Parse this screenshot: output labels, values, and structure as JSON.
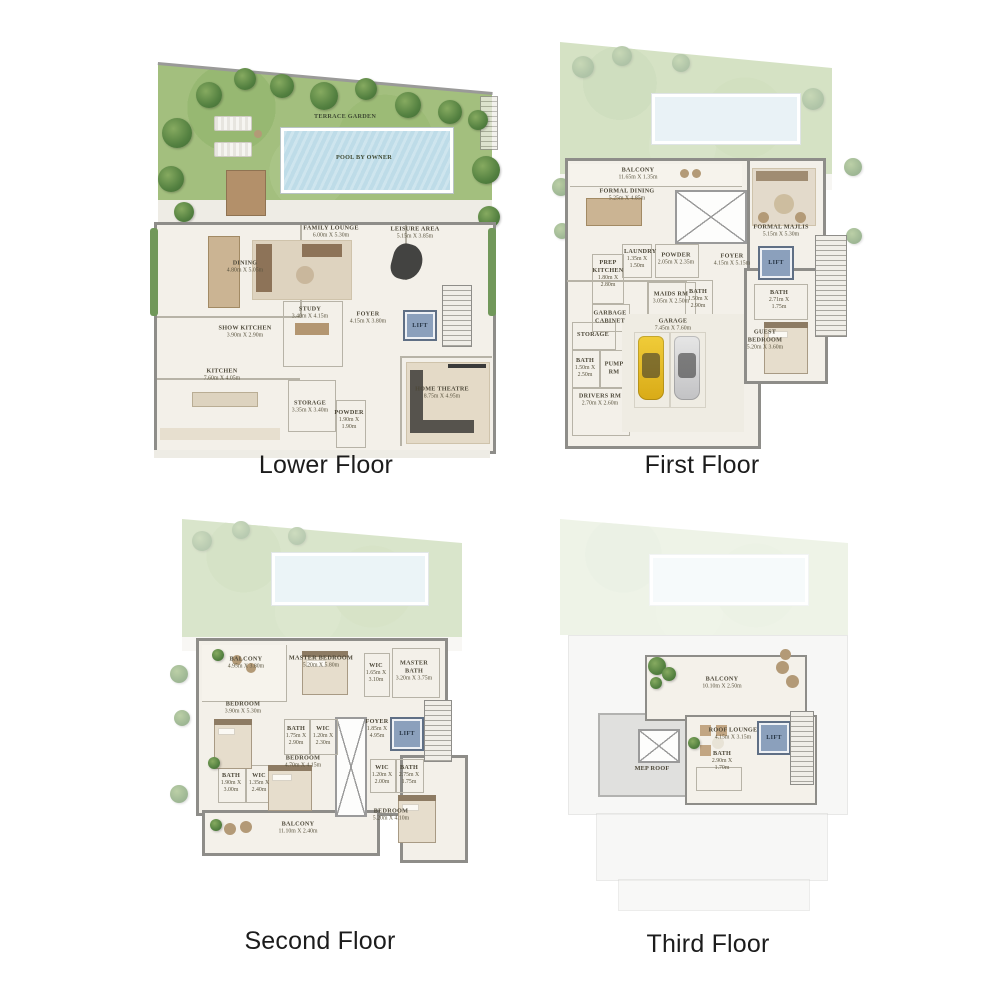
{
  "captions": {
    "lower": "Lower Floor",
    "first": "First Floor",
    "second": "Second Floor",
    "third": "Third Floor"
  },
  "colors": {
    "garden_green": "#a3bf7e",
    "pool_blue": "#bedce8",
    "lift_blue": "#8ba0bc",
    "wall_gray": "#8e8d89",
    "floor_cream": "#f3f0e9"
  },
  "lower": {
    "terrace_garden": "TERRACE GARDEN",
    "pool": "POOL BY OWNER",
    "rooms": {
      "family_lounge": {
        "name": "FAMILY LOUNGE",
        "dims": "6.00m X 5.30m"
      },
      "leisure_area": {
        "name": "LEISURE AREA",
        "dims": "5.15m X 3.85m"
      },
      "dining": {
        "name": "DINING",
        "dims": "4.80m X 5.05m"
      },
      "study": {
        "name": "STUDY",
        "dims": "3.40m X 4.15m"
      },
      "foyer": {
        "name": "FOYER",
        "dims": "4.15m X 3.80m"
      },
      "lift": {
        "name": "LIFT"
      },
      "show_kitchen": {
        "name": "SHOW KITCHEN",
        "dims": "3.90m X 2.90m"
      },
      "kitchen": {
        "name": "KITCHEN",
        "dims": "7.60m X 4.05m"
      },
      "storage": {
        "name": "STORAGE",
        "dims": "3.35m X 3.40m"
      },
      "powder": {
        "name": "POWDER",
        "dims": "1.90m X 1.90m"
      },
      "home_theatre": {
        "name": "HOME THEATRE",
        "dims": "8.75m X 4.95m"
      }
    }
  },
  "first": {
    "rooms": {
      "balcony": {
        "name": "BALCONY",
        "dims": "11.65m X 1.35m"
      },
      "formal_dining": {
        "name": "FORMAL DINING",
        "dims": "5.25m X 4.85m"
      },
      "formal_majlis": {
        "name": "FORMAL MAJLIS",
        "dims": "5.15m X 5.30m"
      },
      "laundry": {
        "name": "LAUNDRY",
        "dims": "1.35m X 1.50m"
      },
      "powder": {
        "name": "POWDER",
        "dims": "2.05m X 2.35m"
      },
      "prep_kitchen": {
        "name": "PREP KITCHEN",
        "dims": "1.80m X 2.80m"
      },
      "foyer": {
        "name": "FOYER",
        "dims": "4.15m X 5.15m"
      },
      "lift": {
        "name": "LIFT"
      },
      "maids_rm": {
        "name": "MAIDS RM",
        "dims": "3.05m X 2.50m"
      },
      "bath_maids": {
        "name": "BATH",
        "dims": "1.50m X 2.90m"
      },
      "garbage_cabinet": {
        "name": "GARBAGE CABINET"
      },
      "storage": {
        "name": "STORAGE"
      },
      "bath_small": {
        "name": "BATH",
        "dims": "1.50m X 2.50m"
      },
      "pump_rm": {
        "name": "PUMP RM"
      },
      "drivers_rm": {
        "name": "DRIVERS RM",
        "dims": "2.70m X 2.60m"
      },
      "garage": {
        "name": "GARAGE",
        "dims": "7.45m X 7.60m"
      },
      "guest_bedroom": {
        "name": "GUEST BEDROOM",
        "dims": "5.20m X 3.60m"
      },
      "bath_guest": {
        "name": "BATH",
        "dims": "2.71m X 1.75m"
      }
    }
  },
  "second": {
    "rooms": {
      "balcony_upper": {
        "name": "BALCONY",
        "dims": "4.95m X 3.80m"
      },
      "master_bedroom": {
        "name": "MASTER BEDROOM",
        "dims": "5.20m X 5.80m"
      },
      "wic_master": {
        "name": "WIC",
        "dims": "1.65m X 3.10m"
      },
      "master_bath": {
        "name": "MASTER BATH",
        "dims": "3.20m X 3.75m"
      },
      "bedroom_left": {
        "name": "BEDROOM",
        "dims": "3.90m X 5.30m"
      },
      "bath_mid": {
        "name": "BATH",
        "dims": "1.75m X 2.90m"
      },
      "wic_mid": {
        "name": "WIC",
        "dims": "1.20m X 2.30m"
      },
      "foyer": {
        "name": "FOYER",
        "dims": "1.85m X 4.95m"
      },
      "lift": {
        "name": "LIFT"
      },
      "bedroom_mid": {
        "name": "BEDROOM",
        "dims": "4.70m X 4.15m"
      },
      "bath_left": {
        "name": "BATH",
        "dims": "1.90m X 3.00m"
      },
      "wic_left": {
        "name": "WIC",
        "dims": "1.35m X 2.40m"
      },
      "balcony_lower": {
        "name": "BALCONY",
        "dims": "11.10m X 2.40m"
      },
      "wic_right": {
        "name": "WIC",
        "dims": "1.20m X 2.00m"
      },
      "bath_right": {
        "name": "BATH",
        "dims": "2.75m X 1.75m"
      },
      "bedroom_right": {
        "name": "BEDROOM",
        "dims": "5.20m X 4.10m"
      }
    }
  },
  "third": {
    "rooms": {
      "balcony": {
        "name": "BALCONY",
        "dims": "10.10m X 2.50m"
      },
      "roof_lounge": {
        "name": "ROOF LOUNGE",
        "dims": "4.15m X 3.15m"
      },
      "bath": {
        "name": "BATH",
        "dims": "2.90m X 1.70m"
      },
      "lift": {
        "name": "LIFT"
      },
      "mep_roof": {
        "name": "MEP ROOF"
      }
    }
  }
}
